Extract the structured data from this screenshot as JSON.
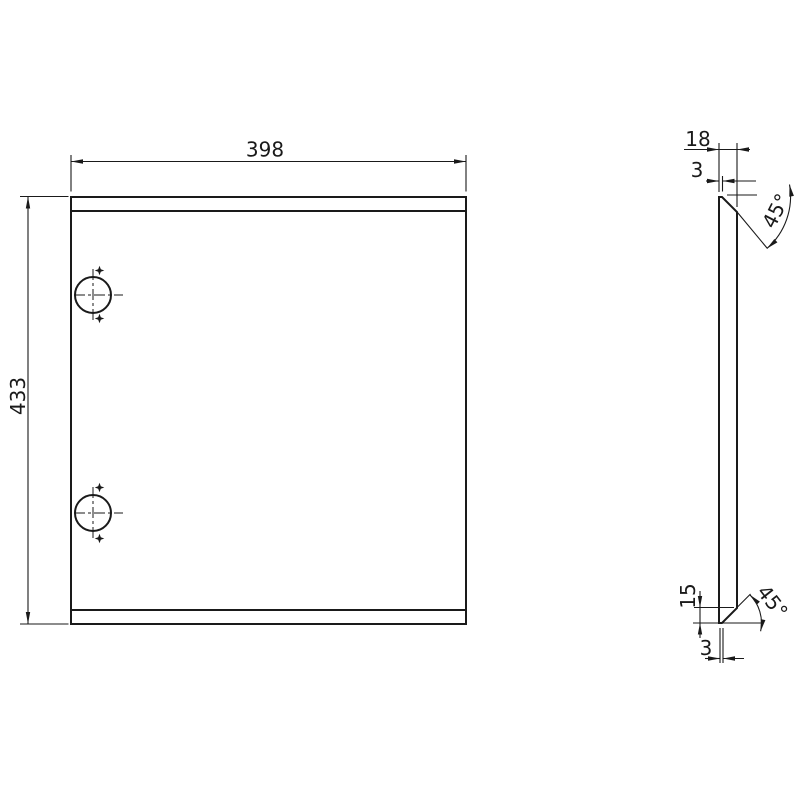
{
  "page": {
    "background_color": "#ffffff",
    "line_color": "#1a1a1a"
  },
  "front_view": {
    "width_dim": "398",
    "height_dim": "433"
  },
  "side_view": {
    "thickness_dim": "18",
    "top_flat_dim": "3",
    "top_chamfer_angle": "45°",
    "bottom_chamfer_height_dim": "15",
    "bottom_flat_dim": "3",
    "bottom_chamfer_angle": "45°"
  }
}
